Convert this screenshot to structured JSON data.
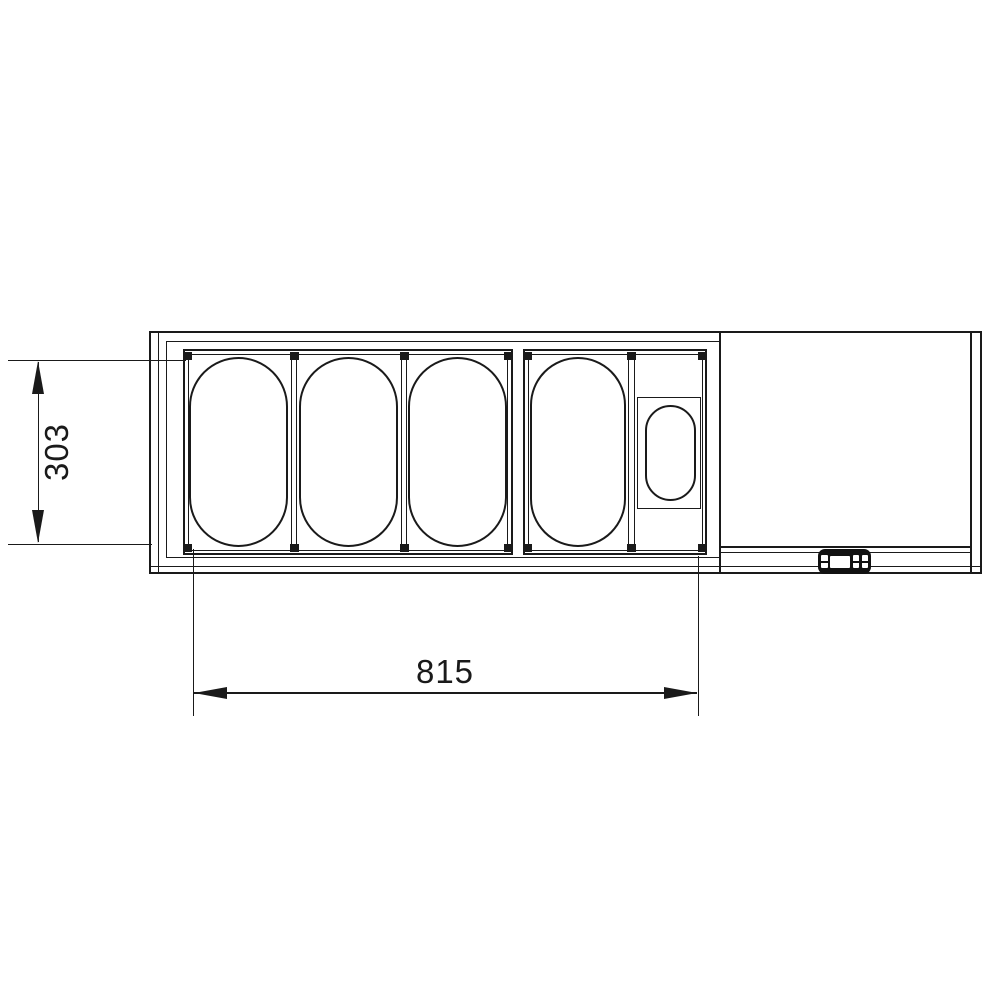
{
  "drawing": {
    "background_color": "#ffffff",
    "line_color": "#1a1a1a",
    "view": "top view line drawing of a refrigerated counter-top pan unit",
    "dimensions": [
      {
        "id": "depth",
        "label": "303",
        "orientation": "vertical"
      },
      {
        "id": "width",
        "label": "815",
        "orientation": "horizontal"
      }
    ],
    "pans": {
      "large_oval_count": 4,
      "small_oval_count": 1
    },
    "control_panel": {
      "type": "digital-controller"
    }
  }
}
